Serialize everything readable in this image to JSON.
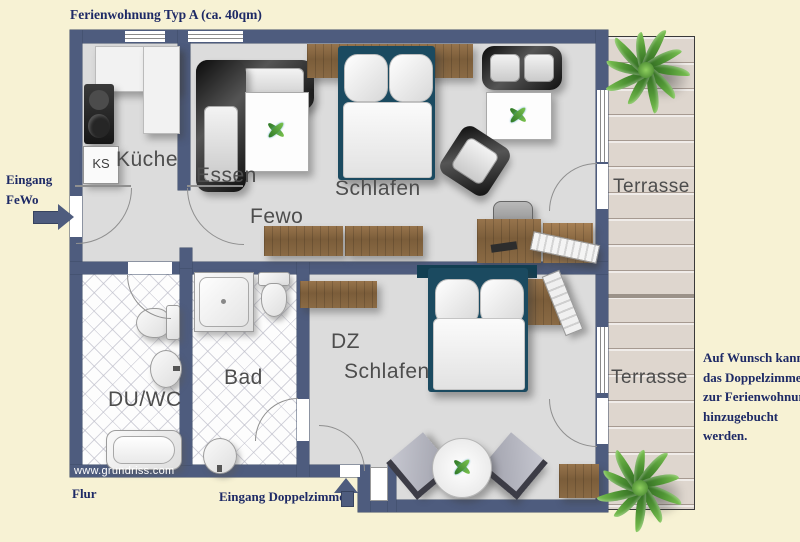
{
  "title": "Ferienwohnung Typ A (ca. 40qm)",
  "watermark": "www.grundriss.com",
  "annotations": {
    "entrance_fewo": {
      "line1": "Eingang",
      "line2": "FeWo"
    },
    "flur": "Flur",
    "entrance_dz": "Eingang Doppelzimmer",
    "note": {
      "line1": "Auf Wunsch kann",
      "line2": "das Doppelzimmer",
      "line3": "zur Ferienwohnung",
      "line4": "hinzugebucht",
      "line5": "werden."
    }
  },
  "rooms": {
    "kueche": "Küche",
    "ks": "KS",
    "essen": "Essen",
    "fewo": "Fewo",
    "schlafen": "Schlafen",
    "dz": {
      "line1": "DZ",
      "line2": "Schlafen"
    },
    "bad": "Bad",
    "duwc": "DU/WC",
    "terrasse_top": "Terrasse",
    "terrasse_bottom": "Terrasse"
  },
  "colors": {
    "background": "#f7f2d4",
    "wall": "#4e5c7e",
    "floor": "#dcdcdc",
    "deck": "#ded6ce",
    "wood": "#8a6a44",
    "bed_frame": "#1b4a60",
    "annotation_text": "#1e2a66",
    "room_label_text": "#4d4d4d",
    "plant_green": "#4f9434"
  }
}
